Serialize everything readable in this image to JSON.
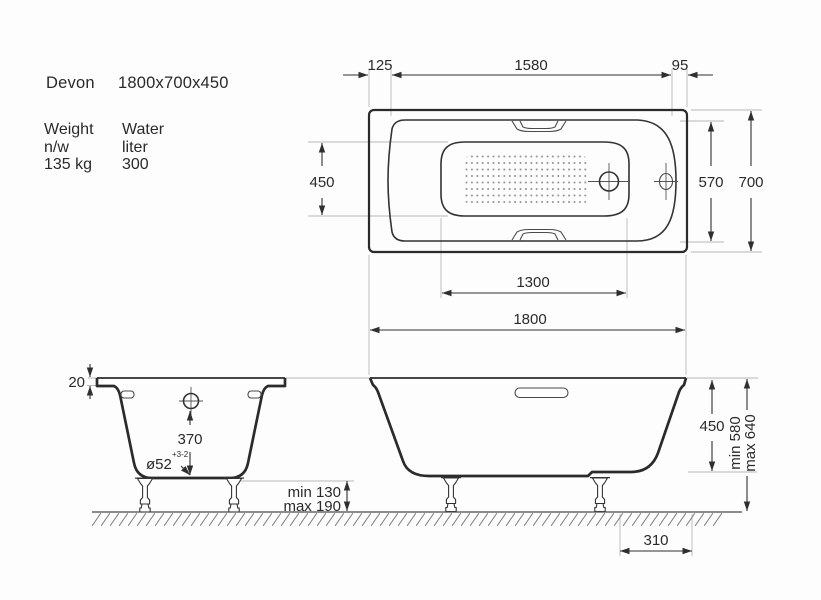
{
  "product": {
    "name": "Devon",
    "dimensions": "1800x700x450",
    "weight": {
      "label": "Weight",
      "sublabel": "n/w",
      "value": "135 kg"
    },
    "water": {
      "label": "Water",
      "sublabel": "liter",
      "value": "300"
    }
  },
  "top_view": {
    "dim_rim_head": "125",
    "dim_inner_length": "1580",
    "dim_rim_foot": "95",
    "dim_basin_width": "450",
    "dim_inner_width": "570",
    "dim_overall_width": "700",
    "dim_basin_length": "1300"
  },
  "front_view": {
    "dim_overall_length": "1800",
    "dim_depth": "450",
    "dim_height_min": "min 580",
    "dim_height_max": "max 640",
    "dim_clearance_min": "min 130",
    "dim_clearance_max": "max 190",
    "dim_drain_offset": "310"
  },
  "end_view": {
    "dim_rim_height": "20",
    "dim_overflow_height": "370",
    "dim_drain_diameter": "ø52",
    "dim_drain_tolerance": "+3-2"
  },
  "colors": {
    "line": "#2b2b2b",
    "dimension": "#2f2f2f",
    "extension": "#b8b8b8",
    "text": "#2a2a2a",
    "background": "#fdfdfd"
  }
}
